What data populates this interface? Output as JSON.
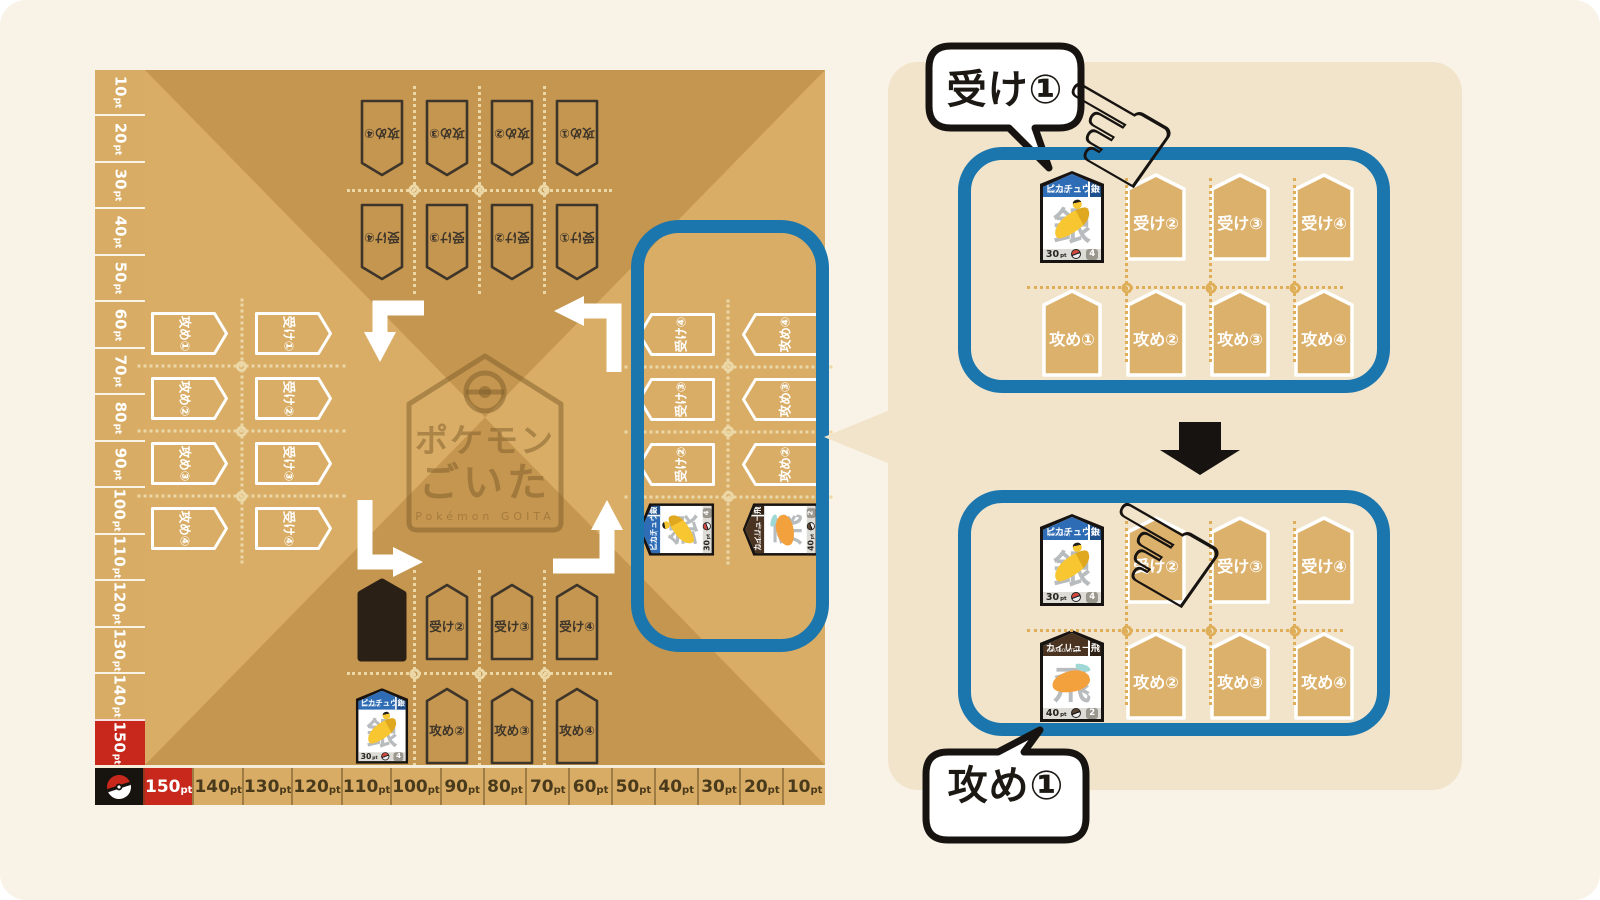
{
  "colors": {
    "board_light": "#d9ad66",
    "board_dark": "#c5964f",
    "accent_blue": "#1b76ad",
    "score_red": "#c8281c",
    "panel_bg": "#f2e4cb",
    "slot_fill": "#dcb16c",
    "outline_dark": "#3e352a",
    "ink": "#171310"
  },
  "unit": "pt",
  "board": {
    "left_scale": [
      "10",
      "20",
      "30",
      "40",
      "50",
      "60",
      "70",
      "80",
      "90",
      "100",
      "110",
      "120",
      "130",
      "140",
      "150"
    ],
    "bottom_scale": [
      "150",
      "140",
      "130",
      "120",
      "110",
      "100",
      "90",
      "80",
      "70",
      "60",
      "50",
      "40",
      "30",
      "20",
      "10"
    ],
    "corner_icon": "pokeball",
    "center_logo": {
      "line1": "ポケモン",
      "line2": "ごいた",
      "subtitle": "Pokémon GOITA"
    },
    "players": {
      "top": {
        "receive": [
          {
            "t": "slot",
            "label": "受け①"
          },
          {
            "t": "slot",
            "label": "受け②"
          },
          {
            "t": "slot",
            "label": "受け③"
          },
          {
            "t": "slot",
            "label": "受け④"
          }
        ],
        "attack": [
          {
            "t": "slot",
            "label": "攻め①"
          },
          {
            "t": "slot",
            "label": "攻め②"
          },
          {
            "t": "slot",
            "label": "攻め③"
          },
          {
            "t": "slot",
            "label": "攻め④"
          }
        ]
      },
      "left": {
        "receive": [
          {
            "t": "slot",
            "label": "受け①"
          },
          {
            "t": "slot",
            "label": "受け②"
          },
          {
            "t": "slot",
            "label": "受け③"
          },
          {
            "t": "slot",
            "label": "受け④"
          }
        ],
        "attack": [
          {
            "t": "slot",
            "label": "攻め①"
          },
          {
            "t": "slot",
            "label": "攻め②"
          },
          {
            "t": "slot",
            "label": "攻め③"
          },
          {
            "t": "slot",
            "label": "攻め④"
          }
        ]
      },
      "bottom": {
        "receive": [
          {
            "t": "down"
          },
          {
            "t": "slot",
            "label": "受け②"
          },
          {
            "t": "slot",
            "label": "受け③"
          },
          {
            "t": "slot",
            "label": "受け④"
          }
        ],
        "attack": [
          {
            "t": "card",
            "card": "pikachu"
          },
          {
            "t": "slot",
            "label": "攻め②"
          },
          {
            "t": "slot",
            "label": "攻め③"
          },
          {
            "t": "slot",
            "label": "攻め④"
          }
        ]
      },
      "right": {
        "receive": [
          {
            "t": "card",
            "card": "pikachu"
          },
          {
            "t": "slot",
            "label": "受け②"
          },
          {
            "t": "slot",
            "label": "受け③"
          },
          {
            "t": "slot",
            "label": "受け④"
          }
        ],
        "attack": [
          {
            "t": "card",
            "card": "dragonite"
          },
          {
            "t": "slot",
            "label": "攻め②"
          },
          {
            "t": "slot",
            "label": "攻め③"
          },
          {
            "t": "slot",
            "label": "攻め④"
          }
        ]
      }
    }
  },
  "cards": {
    "pikachu": {
      "name": "ピカチュウ",
      "romaji": "PIKACHU",
      "points": "30",
      "count": "4",
      "mark": "銀",
      "header_color": "#2e6cb5",
      "chip_color": "#1d4f8d"
    },
    "dragonite": {
      "name": "カイリュー",
      "romaji": "DRAGONITE",
      "points": "40",
      "count": "2",
      "mark": "飛",
      "header_color": "#4a3321",
      "chip_color": "#2e2013"
    }
  },
  "panel": {
    "bubble_receive": "受け①",
    "bubble_attack": "攻め①",
    "grid1": {
      "receive": [
        {
          "t": "card",
          "card": "pikachu"
        },
        {
          "t": "slot",
          "label": "受け②"
        },
        {
          "t": "slot",
          "label": "受け③"
        },
        {
          "t": "slot",
          "label": "受け④"
        }
      ],
      "attack": [
        {
          "t": "slot",
          "label": "攻め①"
        },
        {
          "t": "slot",
          "label": "攻め②"
        },
        {
          "t": "slot",
          "label": "攻め③"
        },
        {
          "t": "slot",
          "label": "攻め④"
        }
      ]
    },
    "grid2": {
      "receive": [
        {
          "t": "card",
          "card": "pikachu"
        },
        {
          "t": "slot",
          "label": "受け②"
        },
        {
          "t": "slot",
          "label": "受け③"
        },
        {
          "t": "slot",
          "label": "受け④"
        }
      ],
      "attack": [
        {
          "t": "card",
          "card": "dragonite"
        },
        {
          "t": "slot",
          "label": "攻め②"
        },
        {
          "t": "slot",
          "label": "攻め③"
        },
        {
          "t": "slot",
          "label": "攻め④"
        }
      ]
    }
  }
}
